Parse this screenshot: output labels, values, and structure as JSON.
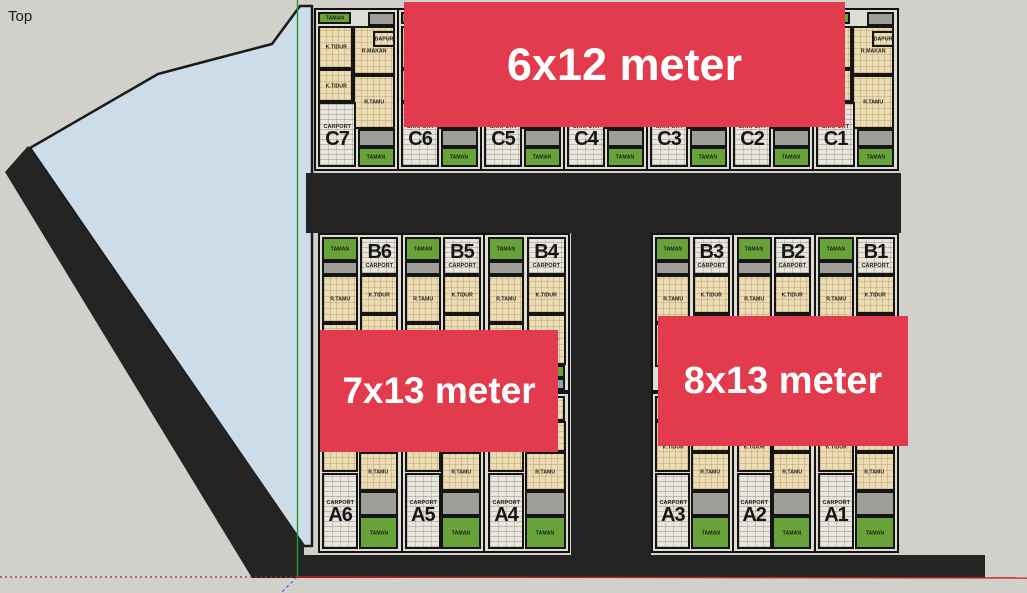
{
  "viewport": {
    "label": "Top"
  },
  "banners": [
    {
      "id": "6x12",
      "label": "6x12 meter"
    },
    {
      "id": "7x13",
      "label": "7x13 meter"
    },
    {
      "id": "8x13",
      "label": "8x13 meter"
    }
  ],
  "room_labels": {
    "bedroom": "K.TIDUR",
    "living": "R.TAMU",
    "dining": "R.MAKAN",
    "kitchen": "DAPUR",
    "bath": "K.MANDI",
    "carport": "CARPORT",
    "garden": "TAMAN"
  },
  "site": {
    "c_row": {
      "size_label": "6x12 meter",
      "units": [
        "C7",
        "C6",
        "C5",
        "C4",
        "C3",
        "C2",
        "C1"
      ]
    },
    "b_left": {
      "size_label": "7x13 meter",
      "units": [
        "B6",
        "B5",
        "B4"
      ]
    },
    "b_right": {
      "size_label": "8x13 meter",
      "units": [
        "B3",
        "B2",
        "B1"
      ]
    },
    "a_left": {
      "size_label": "7x13 meter",
      "units": [
        "A6",
        "A5",
        "A4"
      ]
    },
    "a_right": {
      "size_label": "8x13 meter",
      "units": [
        "A3",
        "A2",
        "A1"
      ]
    }
  },
  "colors": {
    "banner_red": "#e23b4d",
    "garden_green": "#67a338",
    "floor_tan": "#ecdcb4",
    "carport_paving": "#e9e6dd",
    "terrace_gray": "#a09e99",
    "road_black": "#242424",
    "water_blue": "#ccdde9",
    "background": "#d2d0cb",
    "axis_green": "#1f9d1f",
    "axis_red": "#c22222",
    "axis_blue": "#5555dd"
  }
}
